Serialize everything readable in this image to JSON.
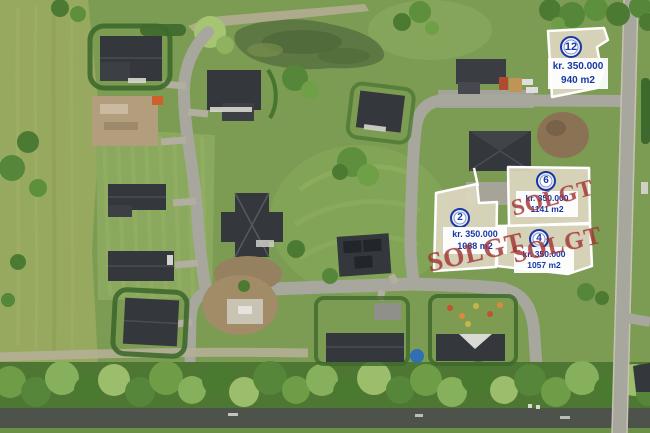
{
  "map": {
    "type": "aerial-photo-lot-map",
    "sold_label": "SOLGT",
    "colors": {
      "label_text_blue": "#1838a6",
      "sold_stamp_red": "#a23434",
      "parcel_fill": "#dcd6bf",
      "parcel_border": "#ffffff"
    },
    "parcels": [
      {
        "number": "12",
        "price": "kr. 350.000",
        "area": "940 m2",
        "sold": false
      },
      {
        "number": "2",
        "price": "kr. 350.000",
        "area": "1068 m2",
        "sold": true
      },
      {
        "number": "6",
        "price": "kr. 350.000",
        "area": "1141 m2",
        "sold": true
      },
      {
        "number": "4",
        "price": "kr. 350.000",
        "area": "1057 m2",
        "sold": true
      }
    ]
  }
}
